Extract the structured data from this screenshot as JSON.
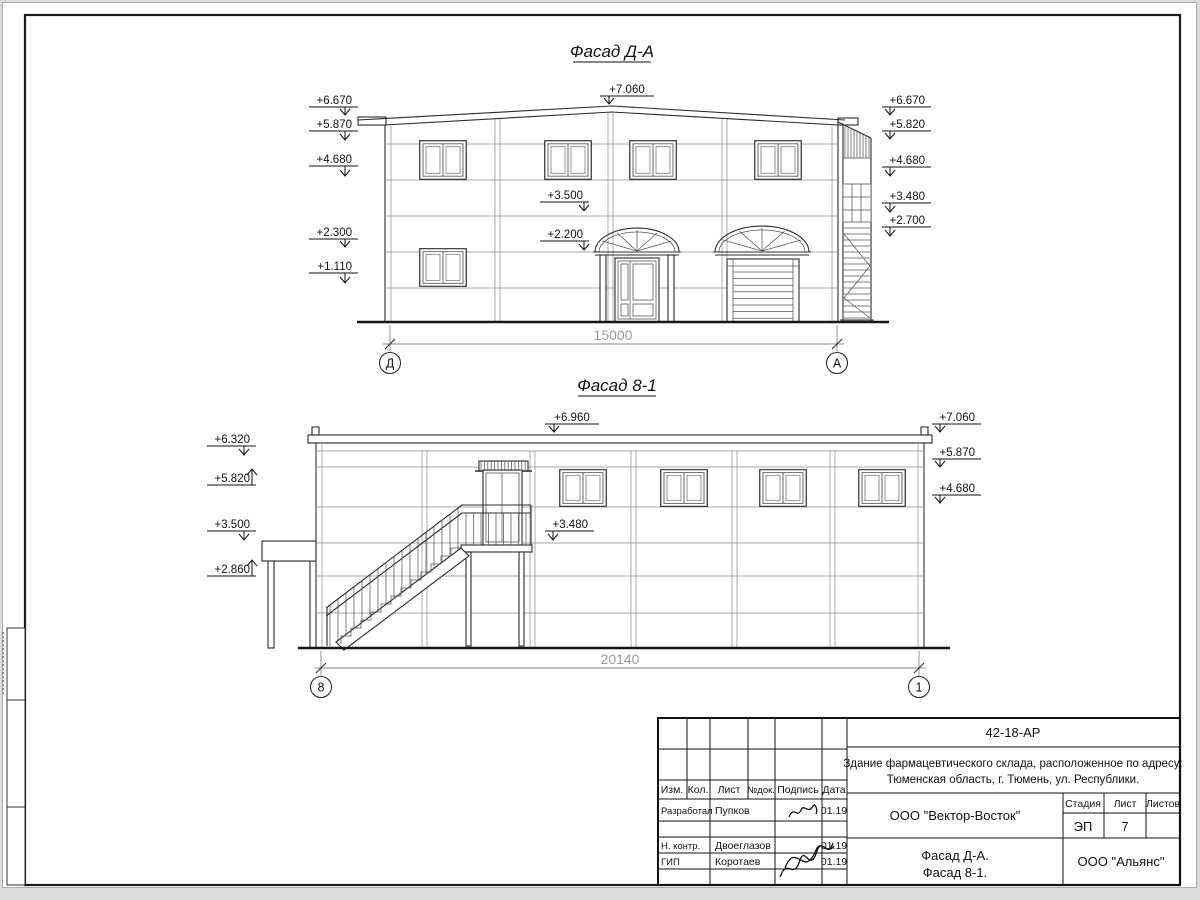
{
  "sheet": {
    "facade1": {
      "title": "Фасад Д-А",
      "dimension": "15000",
      "axis_left": "Д",
      "axis_right": "А",
      "marks": [
        {
          "label": "+6.670",
          "x": 352,
          "y": 104,
          "tip_x": 345,
          "tip_y": 115,
          "dir": "down"
        },
        {
          "label": "+5.870",
          "x": 352,
          "y": 128,
          "tip_x": 345,
          "tip_y": 140,
          "dir": "down"
        },
        {
          "label": "+4.680",
          "x": 352,
          "y": 163,
          "tip_x": 345,
          "tip_y": 176,
          "dir": "down"
        },
        {
          "label": "+2.300",
          "x": 352,
          "y": 236,
          "tip_x": 345,
          "tip_y": 247,
          "dir": "down"
        },
        {
          "label": "+1.110",
          "x": 352,
          "y": 270,
          "tip_x": 345,
          "tip_y": 283,
          "dir": "down"
        },
        {
          "label": "+7.060",
          "x": 627,
          "y": 93,
          "anchor": "middle",
          "tip_x": 609,
          "tip_y": 104,
          "dir": "down"
        },
        {
          "label": "+3.500",
          "x": 583,
          "y": 199,
          "tip_x": 584,
          "tip_y": 211,
          "dir": "down"
        },
        {
          "label": "+2.200",
          "x": 583,
          "y": 238,
          "tip_x": 584,
          "tip_y": 250,
          "dir": "down"
        },
        {
          "label": "+6.670",
          "x": 925,
          "y": 104,
          "tip_x": 890,
          "tip_y": 115,
          "dir": "down"
        },
        {
          "label": "+5.820",
          "x": 925,
          "y": 128,
          "tip_x": 890,
          "tip_y": 139,
          "dir": "down"
        },
        {
          "label": "+4.680",
          "x": 925,
          "y": 164,
          "tip_x": 890,
          "tip_y": 176,
          "dir": "down"
        },
        {
          "label": "+3.480",
          "x": 925,
          "y": 200,
          "tip_x": 890,
          "tip_y": 212,
          "dir": "down"
        },
        {
          "label": "+2.700",
          "x": 925,
          "y": 224,
          "tip_x": 890,
          "tip_y": 236,
          "dir": "down"
        }
      ]
    },
    "facade2": {
      "title": "Фасад 8-1",
      "dimension": "20140",
      "axis_left": "8",
      "axis_right": "1",
      "marks": [
        {
          "label": "+6.320",
          "x": 250,
          "y": 443,
          "tip_x": 244,
          "tip_y": 455,
          "dir": "down"
        },
        {
          "label": "+5.820",
          "x": 250,
          "y": 482,
          "tip_x": 252,
          "tip_y": 469,
          "dir": "up"
        },
        {
          "label": "+3.500",
          "x": 250,
          "y": 528,
          "tip_x": 244,
          "tip_y": 540,
          "dir": "down"
        },
        {
          "label": "+2.860",
          "x": 250,
          "y": 573,
          "tip_x": 252,
          "tip_y": 560,
          "dir": "up"
        },
        {
          "label": "+6.960",
          "x": 572,
          "y": 421,
          "anchor": "middle",
          "tip_x": 554,
          "tip_y": 432,
          "dir": "down"
        },
        {
          "label": "+3.480",
          "x": 588,
          "y": 528,
          "tip_x": 553,
          "tip_y": 540,
          "dir": "down"
        },
        {
          "label": "+7.060",
          "x": 975,
          "y": 421,
          "tip_x": 940,
          "tip_y": 432,
          "dir": "down"
        },
        {
          "label": "+5.870",
          "x": 975,
          "y": 456,
          "tip_x": 940,
          "tip_y": 467,
          "dir": "down"
        },
        {
          "label": "+4.680",
          "x": 975,
          "y": 492,
          "tip_x": 940,
          "tip_y": 503,
          "dir": "down"
        }
      ]
    },
    "titleblock": {
      "doc_number": "42-18-АР",
      "description_line1": "Здание фармацевтического склада, расположенное по адресу:",
      "description_line2": "Тюменская область, г. Тюмень, ул. Республики.",
      "table": {
        "headers": [
          "Изм.",
          "Кол.",
          "Лист",
          "№док.",
          "Подпись",
          "Дата"
        ],
        "rows": [
          {
            "role": "Разработал",
            "name": "Пупков",
            "date": "01.19"
          },
          {
            "role": "Н. контр.",
            "name": "Двоеглазов",
            "date": "01.19"
          },
          {
            "role": "ГИП",
            "name": "Коротаев",
            "date": "01.19"
          }
        ]
      },
      "designer_company": "ООО \"Вектор-Восток\"",
      "stage": {
        "label": "Стадия",
        "value": "ЭП"
      },
      "sheet": {
        "label": "Лист",
        "value": "7"
      },
      "sheets": {
        "label": "Листов",
        "value": ""
      },
      "content_line1": "Фасад Д-А.",
      "content_line2": "Фасад 8-1.",
      "org_company": "ООО \"Альянс\""
    }
  }
}
